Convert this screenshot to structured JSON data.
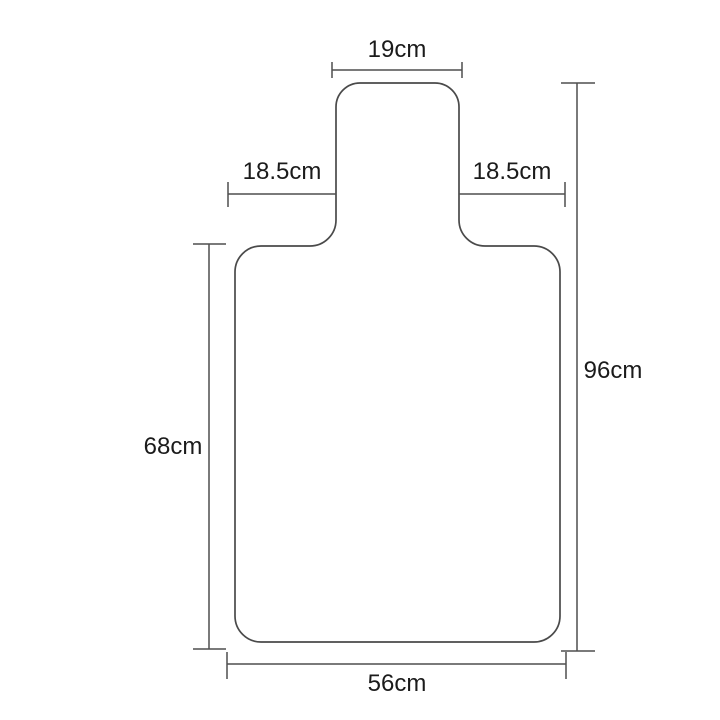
{
  "diagram": {
    "kind": "dimension-drawing",
    "labels": {
      "neck_width": "19cm",
      "left_shoulder": "18.5cm",
      "right_shoulder": "18.5cm",
      "overall_height": "96cm",
      "body_height": "68cm",
      "bottom_width": "56cm"
    },
    "colors": {
      "outline_line": "#4a4a4a",
      "dimension_line": "#4f4f4f",
      "text": "#1b1b1b",
      "background": "#ffffff"
    }
  }
}
